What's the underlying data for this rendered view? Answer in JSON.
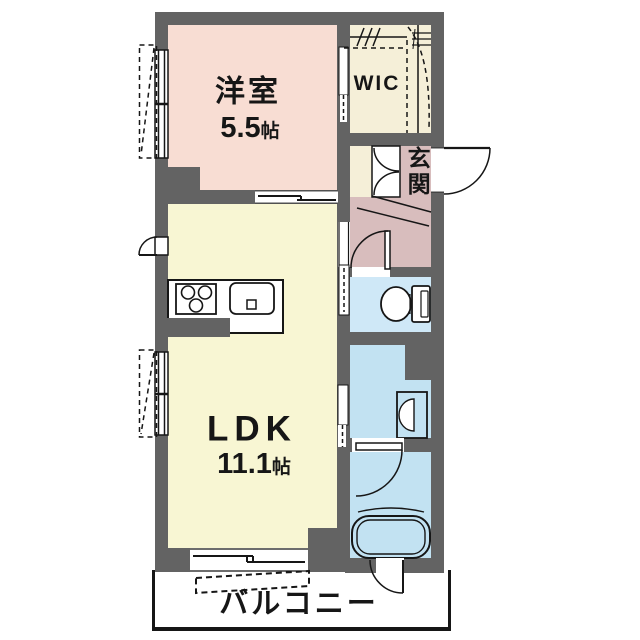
{
  "floorplan": {
    "rooms": {
      "western_room": {
        "label": "洋室",
        "size_value": "5.5",
        "size_unit": "帖"
      },
      "wic": {
        "label": "WIC"
      },
      "entrance": {
        "label": "玄関"
      },
      "ldk": {
        "label": "LDK",
        "size_value": "11.1",
        "size_unit": "帖"
      },
      "balcony": {
        "label": "バルコニー"
      }
    },
    "colors": {
      "wall": "#636363",
      "outline": "#161616",
      "western_room": "#f8ddd3",
      "wic": "#f5efd8",
      "entrance_hall": "#d8bdbd",
      "ldk": "#f8f6d3",
      "toilet": "#cfe8f7",
      "bathroom": "#c2e2f2",
      "background": "#ffffff"
    },
    "fixtures": [
      {
        "name": "stove-burners",
        "room": "ldk-kitchen"
      },
      {
        "name": "kitchen-sink",
        "room": "ldk-kitchen"
      },
      {
        "name": "toilet",
        "room": "toilet"
      },
      {
        "name": "washbasin",
        "room": "washroom"
      },
      {
        "name": "bathtub",
        "room": "bathroom"
      },
      {
        "name": "hanger-pipe-shelf",
        "room": "wic"
      },
      {
        "name": "shoe-cabinet",
        "room": "entrance"
      },
      {
        "name": "evacuation-hatch",
        "room": "balcony"
      }
    ]
  }
}
